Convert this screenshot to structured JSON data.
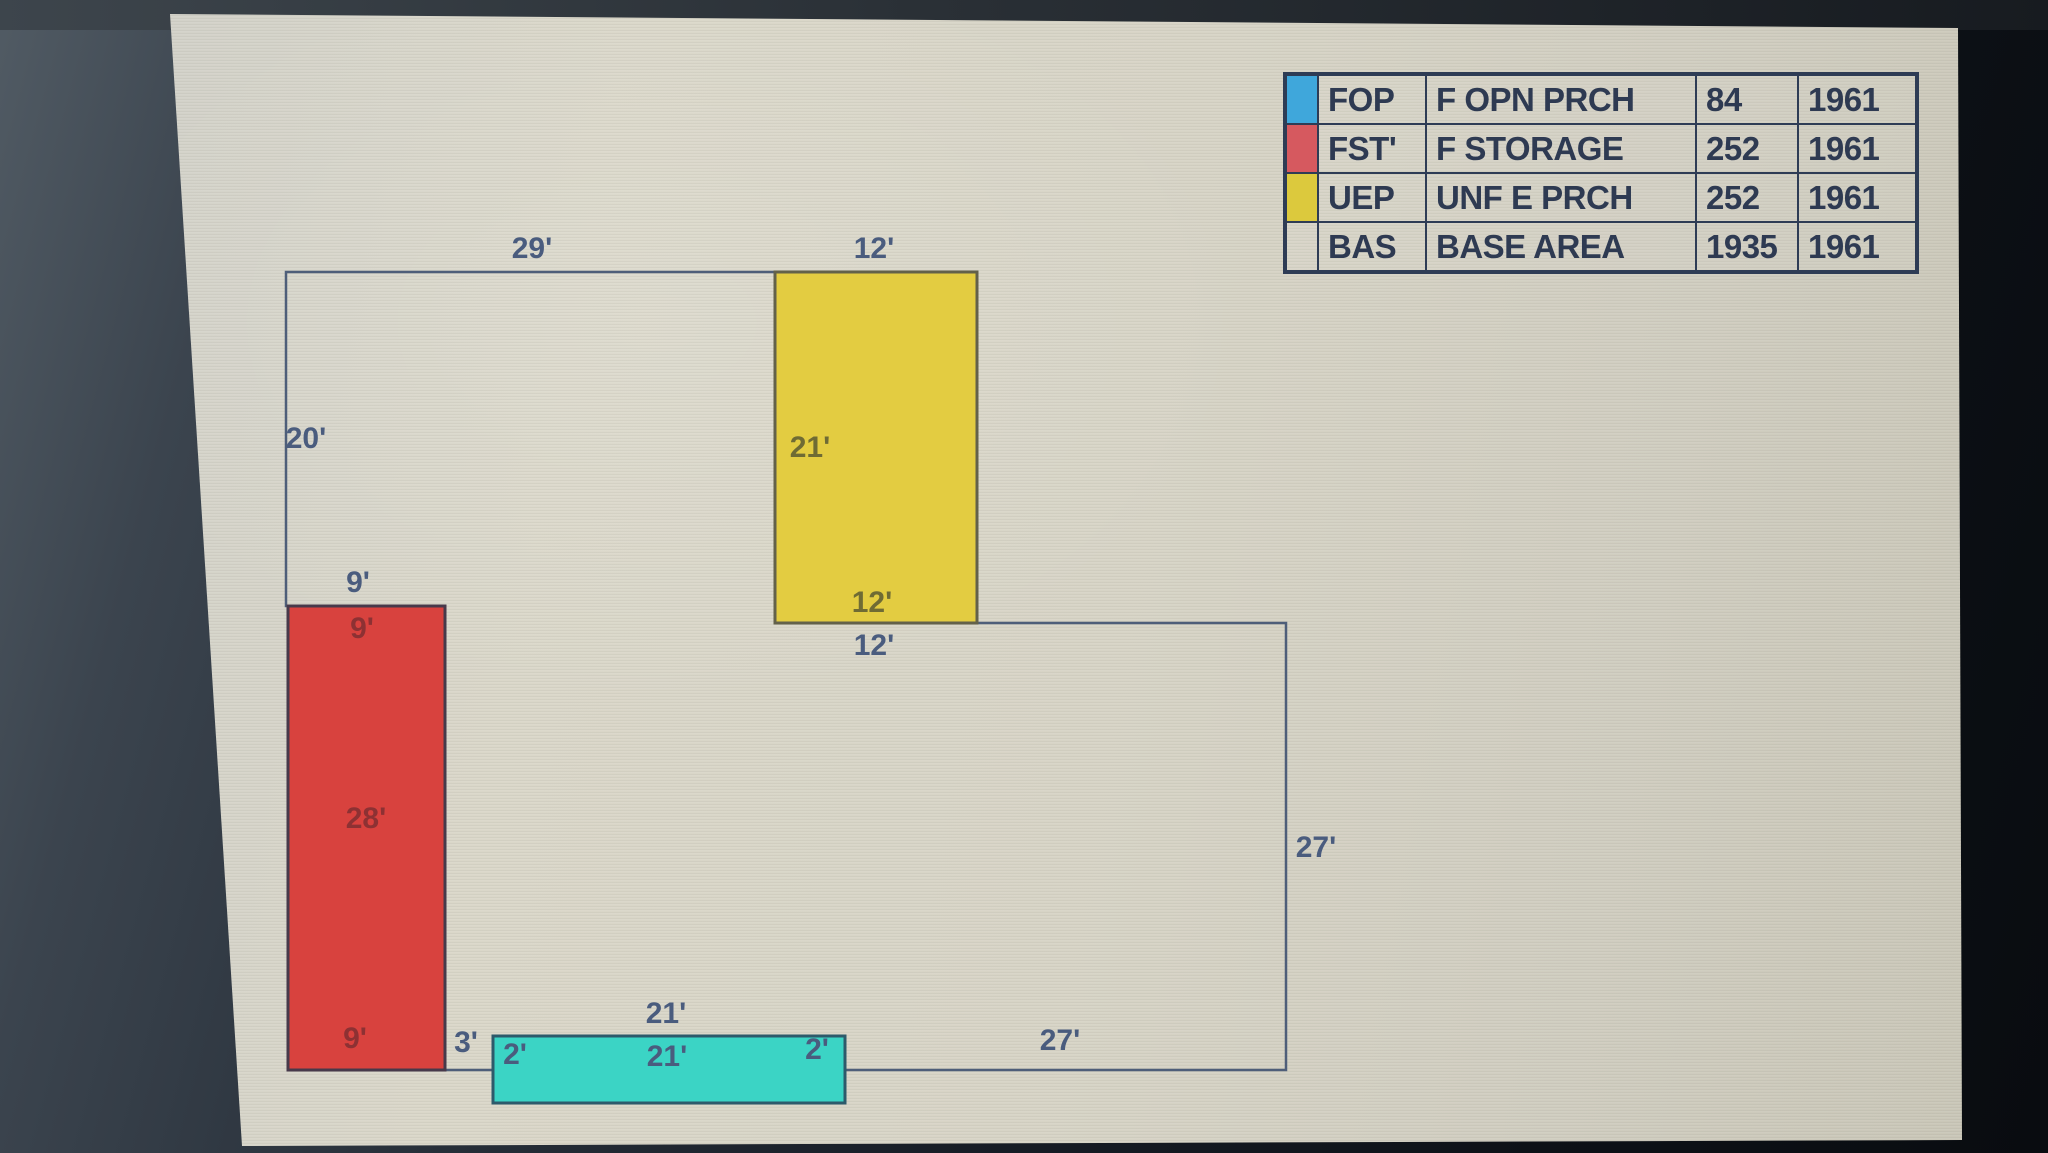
{
  "palette": {
    "dim_navy": "#4a5c7e",
    "dim_olive": "#6f6b34",
    "dim_maroon": "#8d3133",
    "outline": "#4e5e79",
    "table_border": "#2e3c55",
    "table_text": "#2e3a52",
    "swatch_fop": "#3fa7db",
    "swatch_fst": "#d6595f",
    "swatch_uep": "#dcc93d",
    "uep_fill": "#e3cc41",
    "uep_stroke": "#63614a",
    "fst_fill": "#d8423e",
    "fst_stroke": "#47394a",
    "fop_fill": "#3bd4c5",
    "fop_stroke": "#2d5a6b",
    "screen_background": "#d6d3c5"
  },
  "legend_table": {
    "rows": [
      {
        "code": "FOP",
        "description": "F OPN PRCH",
        "area": "84",
        "year": "1961"
      },
      {
        "code": "FST'",
        "description": "F STORAGE",
        "area": "252",
        "year": "1961"
      },
      {
        "code": "UEP",
        "description": "UNF E PRCH",
        "area": "252",
        "year": "1961"
      },
      {
        "code": "BAS",
        "description": "BASE AREA",
        "area": "1935",
        "year": "1961"
      }
    ]
  },
  "sketch": {
    "labels": {
      "top_width": "29'",
      "uep_top_width": "12'",
      "left_height": "20'",
      "uep_height": "21'",
      "uep_bottom_width": "12'",
      "base_upper_width": "12'",
      "fst_top_width_outer": "9'",
      "fst_top_width_inner": "9'",
      "fst_height": "28'",
      "fst_bottom_width": "9'",
      "gap_width": "3'",
      "fop_top_width": "21'",
      "fop_inner_width": "21'",
      "fop_left_depth": "2'",
      "fop_right_depth": "2'",
      "base_right_height": "27'",
      "base_bottom_width": "27'"
    }
  }
}
